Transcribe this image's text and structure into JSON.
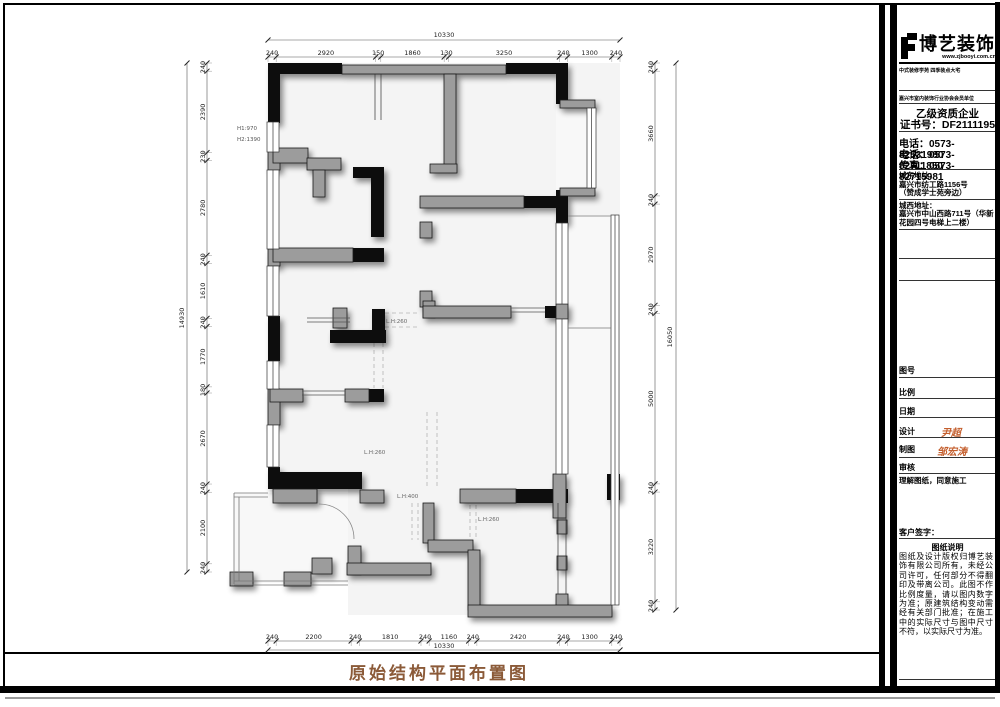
{
  "sheet": {
    "drawing_title": "原始结构平面布置图"
  },
  "title_block": {
    "company_name": "博艺装饰",
    "website": "www.zjbooyi.com.cn",
    "tagline": "中式装修学苑  四季装点大宅",
    "membership": "嘉兴市室内装饰行业协会会员单位",
    "qualification": "乙级资质企业",
    "certificate": "证书号：DF2111195",
    "phone1": "电话：0573-82531980",
    "phone2": "电话：0573-82711850",
    "fax": "传真：0573-82715981",
    "addr_east_label": "城东地址：",
    "addr_east_1": "嘉兴市纺工路1156号",
    "addr_east_2": "（赞成学士苑旁边）",
    "addr_west_label": "城西地址：",
    "addr_west": "嘉兴市中山西路711号（华新花园四号电梯上二楼）",
    "fields": {
      "drawing_no": "图号",
      "scale": "比例",
      "date": "日期",
      "design": "设计",
      "draft": "制图",
      "review": "审核"
    },
    "designer": "尹超",
    "drafter": "邹宏涛",
    "approval_note": "理解图纸，同意施工",
    "client_sign": "客户签字：",
    "notes_title": "图纸说明",
    "notes_body": "图纸及设计版权归博艺装饰有限公司所有，未经公司许可，任何部分不得翻印及带离公司。此图不作比例度量，请以图内数字为准；原建筑结构变动需经有关部门批准；在施工中的实际尺寸与图中尺寸不符，以实际尺寸为准。"
  },
  "plan": {
    "dims": {
      "top_total": "10330",
      "top_chain": [
        "240",
        "2920",
        "150",
        "1860",
        "130",
        "3250",
        "240",
        "1300",
        "240"
      ],
      "bottom_chain": [
        "240",
        "2200",
        "240",
        "1810",
        "240",
        "1160",
        "240",
        "2420",
        "240",
        "1300",
        "240"
      ],
      "bottom_total": "10330",
      "left_total": "14930",
      "left_chain": [
        "240",
        "2390",
        "230",
        "2780",
        "240",
        "1610",
        "240",
        "1770",
        "180",
        "2670",
        "240",
        "2100",
        "240"
      ],
      "right_chain": [
        "240",
        "3660",
        "240",
        "2970",
        "240",
        "5000",
        "240",
        "3220",
        "240"
      ],
      "right_total": "16050"
    },
    "labels": {
      "h1": "H1:970",
      "h2": "H2:1390",
      "lh260": "L.H:260",
      "lh400": "L.H:400"
    }
  }
}
